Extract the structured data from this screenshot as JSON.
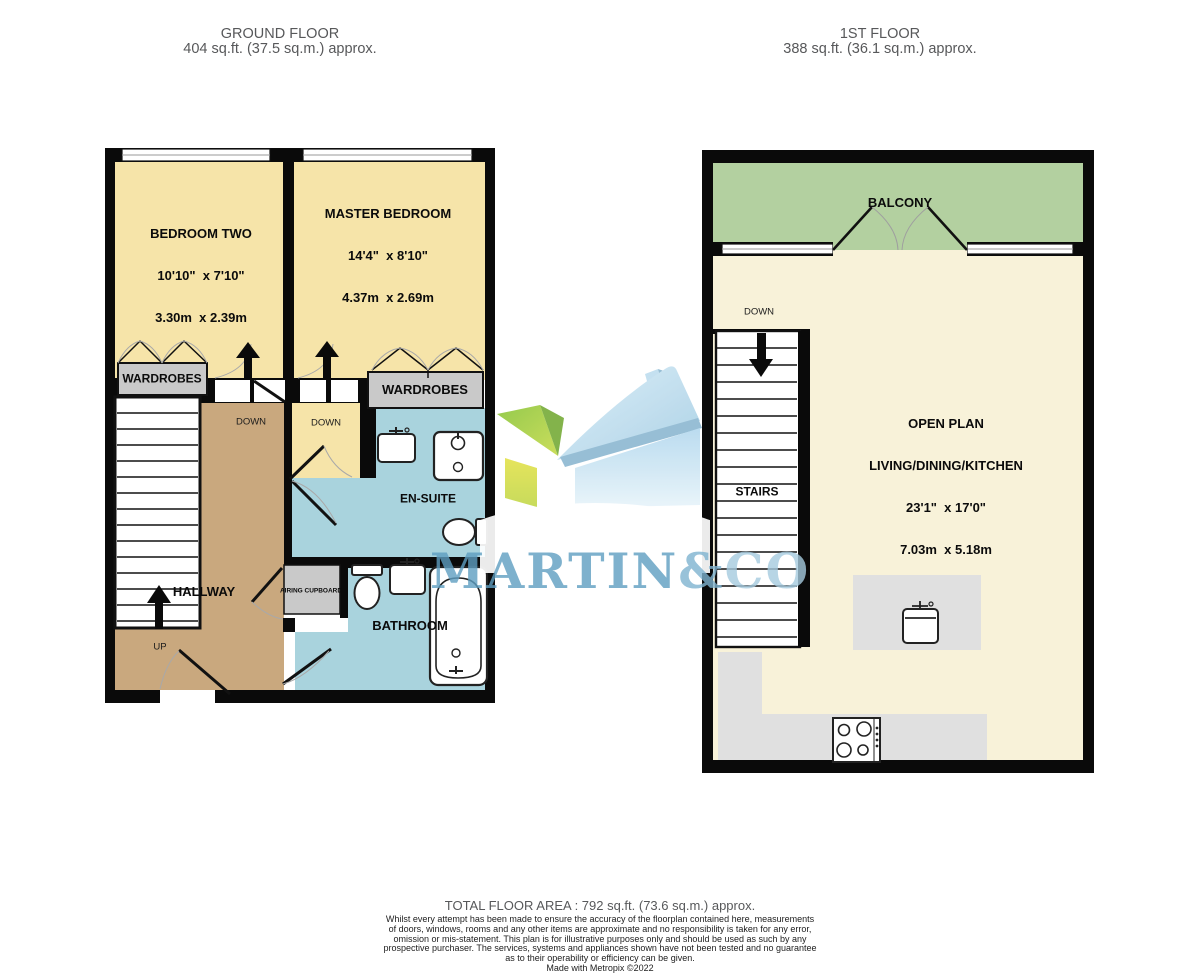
{
  "headers": {
    "ground": {
      "title": "GROUND FLOOR",
      "area": "404 sq.ft. (37.5 sq.m.) approx."
    },
    "first": {
      "title": "1ST FLOOR",
      "area": "388 sq.ft. (36.1 sq.m.) approx."
    }
  },
  "ground_floor": {
    "bedroom_two": {
      "name": "BEDROOM TWO",
      "dims_imperial": "10'10\"  x 7'10\"",
      "dims_metric": "3.30m  x 2.39m"
    },
    "master_bedroom": {
      "name": "MASTER BEDROOM",
      "dims_imperial": "14'4\"  x 8'10\"",
      "dims_metric": "4.37m  x 2.69m"
    },
    "wardrobes_left": "WARDROBES",
    "wardrobes_right": "WARDROBES",
    "hallway": "HALLWAY",
    "en_suite": "EN-SUITE",
    "bathroom": "BATHROOM",
    "airing_cupboard": "AIRING CUPBOARD",
    "down_hallway": "DOWN",
    "down_landing": "DOWN",
    "up": "UP"
  },
  "first_floor": {
    "balcony": "BALCONY",
    "stairs": "STAIRS",
    "down": "DOWN",
    "open_plan": {
      "name_line1": "OPEN PLAN",
      "name_line2": "LIVING/DINING/KITCHEN",
      "dims_imperial": "23'1\"  x 17'0\"",
      "dims_metric": "7.03m  x 5.18m"
    }
  },
  "watermark": {
    "part1": "MARTIN",
    "part2": "&",
    "part3": "CO"
  },
  "footer": {
    "total": "TOTAL FLOOR AREA : 792 sq.ft. (73.6 sq.m.) approx.",
    "disclaimer_lines": [
      "Whilst every attempt has been made to ensure the accuracy of the floorplan contained here, measurements",
      "of doors, windows, rooms and any other items are approximate and no responsibility is taken for any error,",
      "omission or mis-statement. This plan is for illustrative purposes only and should be used as such by any",
      "prospective purchaser. The services, systems and appliances shown have not been tested and no guarantee",
      "as to their operability or efficiency can be given.",
      "Made with Metropix ©2022"
    ]
  },
  "colors": {
    "wall": "#0a0a0a",
    "bedroom_floor": "#f6e4a9",
    "open_plan_floor": "#f8f2d9",
    "hallway_floor": "#c9a87e",
    "wet_room_floor": "#a9d3dd",
    "balcony_floor": "#b3d0a0",
    "storage_gray": "#c9c9c9",
    "counter_gray": "#e0e0e0",
    "header_text": "#57585a",
    "watermark_blue": "#5e9ec1"
  }
}
